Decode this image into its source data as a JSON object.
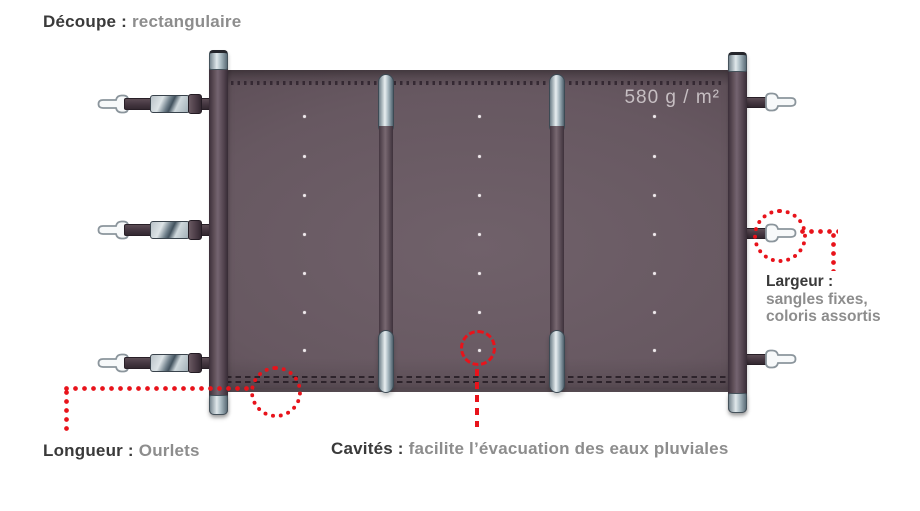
{
  "title": {
    "label": "Découpe :",
    "value": "rectangulaire"
  },
  "cover": {
    "weight": "580 g / m²"
  },
  "annotations": {
    "longueur": {
      "label": "Longueur :",
      "value": "Ourlets"
    },
    "largeur": {
      "label": "Largeur :",
      "line1": "sangles fixes,",
      "line2": "coloris assortis"
    },
    "cavites": {
      "label": "Cavités :",
      "value": "facilite l’évacuation des eaux pluviales"
    }
  },
  "colors": {
    "accent_red": "#e8131b",
    "fabric": "#63545d",
    "label_dark": "#3a3a3a",
    "label_gray": "#8d8d8d",
    "metal_light": "#e0e8eb"
  }
}
